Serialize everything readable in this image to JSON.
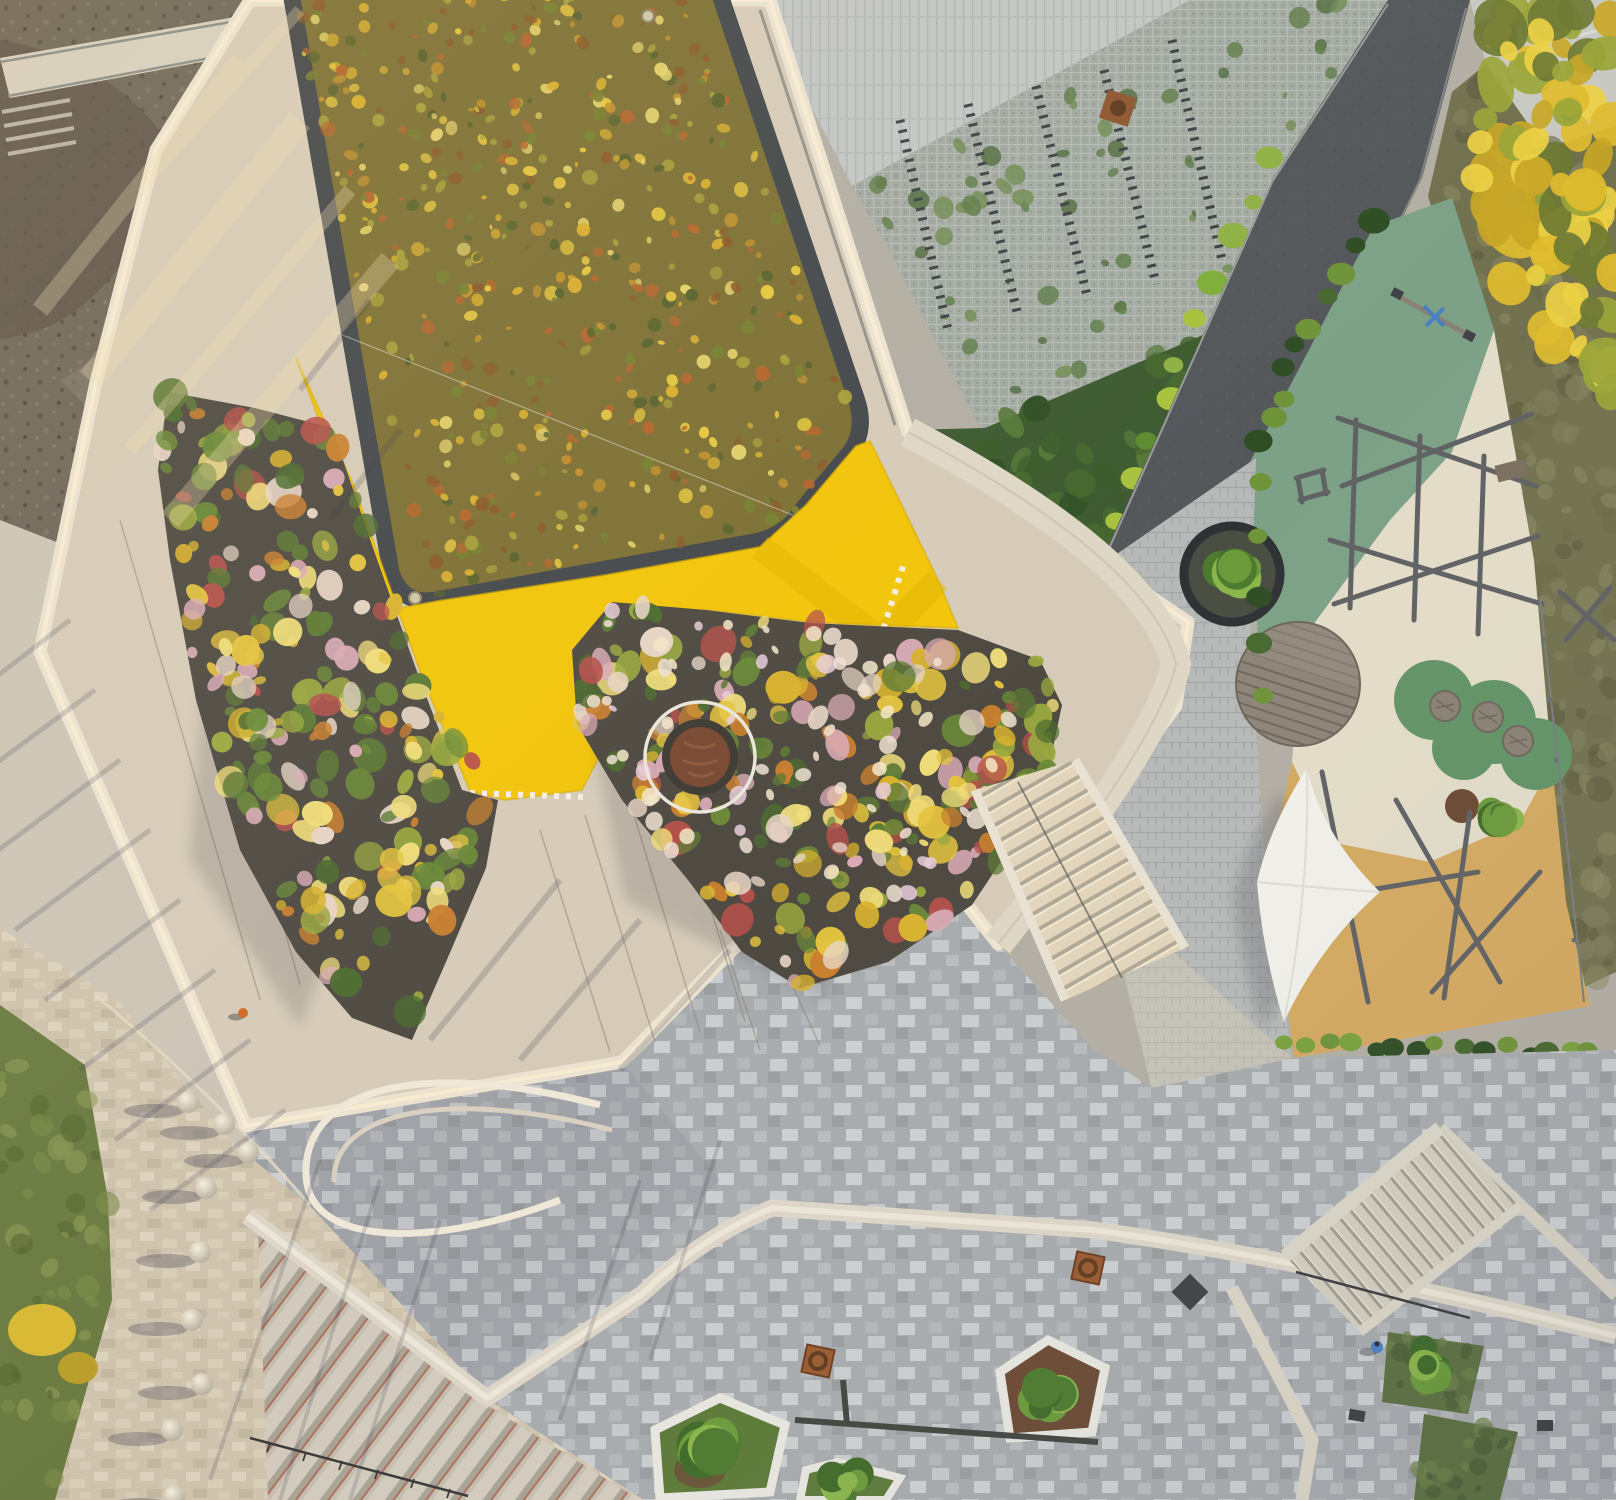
{
  "meta": {
    "title": "Aerial top-down drone photograph at golden hour: school building with autumn sedum green roof, bright yellow facade band, rooftop ornamental-grass gardens, curved white parapet walkways, access road, children's playground with climbing frames and shade sail, and paved plazas with stairs, planters and bollards",
    "type": "aerial-photograph",
    "width_px": 1616,
    "height_px": 1500
  },
  "colors": {
    "terrace": "#d6cbb8",
    "rim": "#ebe2d0",
    "rimGlow": "#f8ecd2",
    "greenRoofBase": "#7d7034",
    "gravelBorder": "#44484b",
    "yellowWall": "#f2c50a",
    "roadAsphalt": "#53575a",
    "playgroundGreen": "#7ca186",
    "playgroundCream": "#e2dcc8",
    "playgroundTan": "#d4a960",
    "playgroundCloud": "#639366",
    "canopyWhite": "#f1f0ea",
    "deckWood": "#8d8478",
    "dryGrass": "#72714f",
    "lawn": "#6a7a40",
    "shrubDark": "#3e5a30",
    "plazaBase": "#a8abad",
    "pathBeige": "#cfc3ad",
    "dirt": "#6e6659",
    "gardenSoil": "#4e4a42",
    "corten": "#9a5a30",
    "bollard": "#e9e2d2",
    "accentBlue": "#4a80c2",
    "accentOrange": "#d06a28",
    "westZone": "#ccc5b6",
    "gridPaver": "#a2a9a1",
    "stairWarm": "#ddd2bc"
  },
  "scene": {
    "time_of_day": "low sun, long shadows toward south-west",
    "landmarks": [
      {
        "name": "green-sedum-roof",
        "desc": "large rounded rectangle of mottled orange/yellow/olive autumn sedum with dark gravel border"
      },
      {
        "name": "yellow-wall",
        "desc": "bright yellow sloped facade band wrapping the roof's south-east side"
      },
      {
        "name": "rooftop-gardens",
        "desc": "two beds of ornamental grasses in yellow, green, pink and rust tones"
      },
      {
        "name": "corten-circle",
        "desc": "rust-coloured round platform with thin white ring inside the central garden"
      },
      {
        "name": "white-parapet",
        "desc": "curved cream parapet walkway outlining the whole roof terrace"
      },
      {
        "name": "construction-dirt",
        "desc": "bare brown gravel site in the top-left corner"
      },
      {
        "name": "access-road",
        "desc": "dark asphalt ramp running diagonally on the right"
      },
      {
        "name": "grass-grid-parking",
        "desc": "concrete grass-grid pavers with moss and rows of dark racks, top centre"
      },
      {
        "name": "playground",
        "desc": "green, cream and tan rubber surfacing, timber climbing poles, seesaw, round timber deck, three drum tables on a green cloud, white shade sail"
      },
      {
        "name": "plaza",
        "desc": "grey checkered paver plaza with pentagonal tree planters, corten drains, white curb bands and wide stairs"
      },
      {
        "name": "bollards",
        "desc": "row of white sphere bollards along the beige path, bottom left"
      }
    ]
  }
}
